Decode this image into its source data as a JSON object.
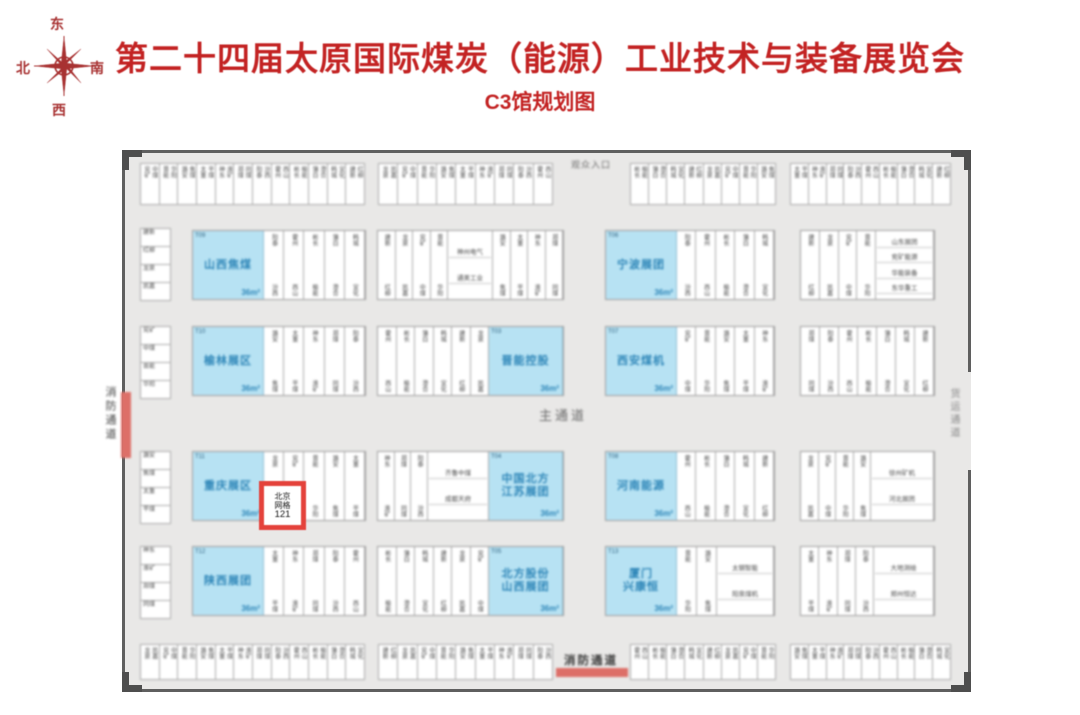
{
  "header": {
    "title": "第二十四届太原国际煤炭（能源）工业技术与装备展览会",
    "subtitle": "C3馆规划图"
  },
  "compass": {
    "top": "东",
    "right": "南",
    "bottom": "西",
    "left": "北"
  },
  "plan": {
    "center_aisle_label": "主通道",
    "top_gate_label": "观众入口",
    "bottom_gate_label": "消防通道",
    "left_exit_label": "消防通道",
    "right_exit_label": "货运通道",
    "area_label": "36m²",
    "highlight_booth": {
      "lines": [
        "北京",
        "网格",
        "121"
      ]
    },
    "colors": {
      "title_red": "#c32323",
      "wall_gray": "#5f5f5f",
      "floor_gray": "#e9e8e7",
      "booth_blue": "#b7e2f3",
      "blue_text": "#2e86b8",
      "highlight_red": "#e4423b",
      "fire_bar_red": "#dd6f68"
    },
    "blue_booths": {
      "r1c1": {
        "num": "T09",
        "lines": [
          "山西焦煤"
        ]
      },
      "r1c3": {
        "num": "T06",
        "lines": [
          "宁波展团"
        ]
      },
      "r2c1": {
        "num": "T10",
        "lines": [
          "榆林展区"
        ]
      },
      "r2c2": {
        "num": "T03",
        "lines": [
          "晋能控股"
        ]
      },
      "r2c3": {
        "num": "T07",
        "lines": [
          "西安煤机"
        ]
      },
      "r3c1": {
        "num": "T11",
        "lines": [
          "重庆展区"
        ]
      },
      "r3c2": {
        "num": "T04",
        "lines": [
          "中国北方",
          "江苏展团"
        ]
      },
      "r3c3": {
        "num": "T08",
        "lines": [
          "河南能源"
        ]
      },
      "r4c1": {
        "num": "T12",
        "lines": [
          "陕西展团"
        ]
      },
      "r4c2": {
        "num": "T05",
        "lines": [
          "北方股份",
          "山西展团"
        ]
      },
      "r4c3": {
        "num": "T13",
        "lines": [
          "厦门",
          "兴康恒"
        ]
      }
    },
    "wide_cells": {
      "w_r1c2": [
        "神州电气",
        "通美工业"
      ],
      "w_r1c4": [
        "山东展团",
        "兖矿能源",
        "华能装备",
        "东华重工"
      ],
      "w_r3c2": [
        "齐鲁中煤",
        "成都天府"
      ],
      "w_r3c4": [
        "徐州矿机",
        "河北展团"
      ],
      "w_r4c3": [
        "太钢智能",
        "阳泉煤机"
      ],
      "w_r4c4": [
        "大地测绘",
        "郑州恒达"
      ]
    },
    "filler": [
      "兖矿",
      "中煤",
      "晋能",
      "华阳",
      "潞安",
      "焦煤",
      "太重",
      "平煤",
      "神东",
      "淮矿",
      "郑煤",
      "同煤",
      "阳泰",
      "汾西",
      "霍州",
      "西山",
      "彬长",
      "榆能",
      "蒲白",
      "澄合",
      "韩城",
      "宜化",
      "建新",
      "红柳",
      "龙泉",
      "凯嘉"
    ]
  }
}
